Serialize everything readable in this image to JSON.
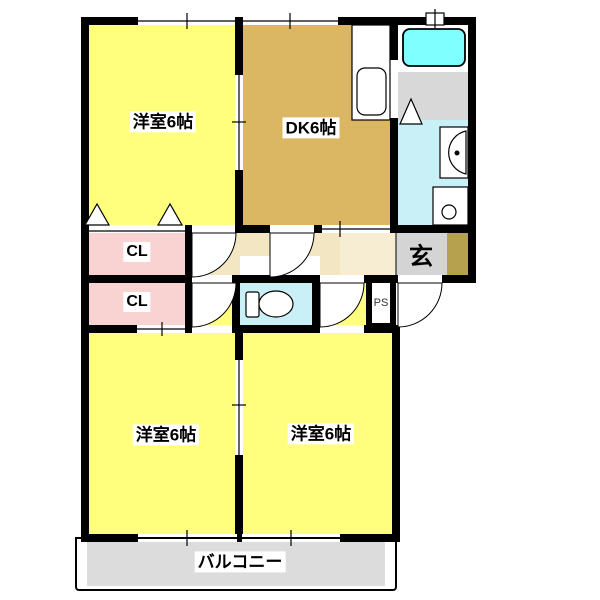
{
  "floorplan": {
    "type": "apartment-2LDK-style-floorplan",
    "rooms": {
      "bedroom_top_left": {
        "label": "洋室6帖",
        "color": "#FFFF7D"
      },
      "dining_kitchen": {
        "label": "DK6帖",
        "color": "#DBB763"
      },
      "closet_top": {
        "label": "CL",
        "color": "#F9D2D2"
      },
      "closet_bottom": {
        "label": "CL",
        "color": "#F9D2D2"
      },
      "entrance": {
        "label": "玄",
        "color": "#D4D4D4"
      },
      "pipe_shaft": {
        "label": "PS",
        "color": "#FFFFFF"
      },
      "bedroom_bottom_left": {
        "label": "洋室6帖",
        "color": "#FFFF7D"
      },
      "bedroom_bottom_right": {
        "label": "洋室6帖",
        "color": "#FFFF7D"
      },
      "balcony": {
        "label": "バルコニー",
        "color": "#DCDCDC"
      },
      "hallway": {
        "color": "#F3E6C2"
      },
      "bathroom": {
        "color": "#7FFFFF"
      },
      "washroom": {
        "color": "#C9EFF7"
      },
      "toilet": {
        "color": "#C9EFF7"
      },
      "utility": {
        "color": "#D8D8D8"
      },
      "shoe_cabinet": {
        "color": "#B5A14E"
      }
    },
    "fixtures": [
      "bathtub",
      "kitchen-sink",
      "vanity-basin",
      "washing-machine-pan",
      "toilet",
      "door-swing x5",
      "folding-door-triangles x3",
      "windows x5"
    ]
  }
}
